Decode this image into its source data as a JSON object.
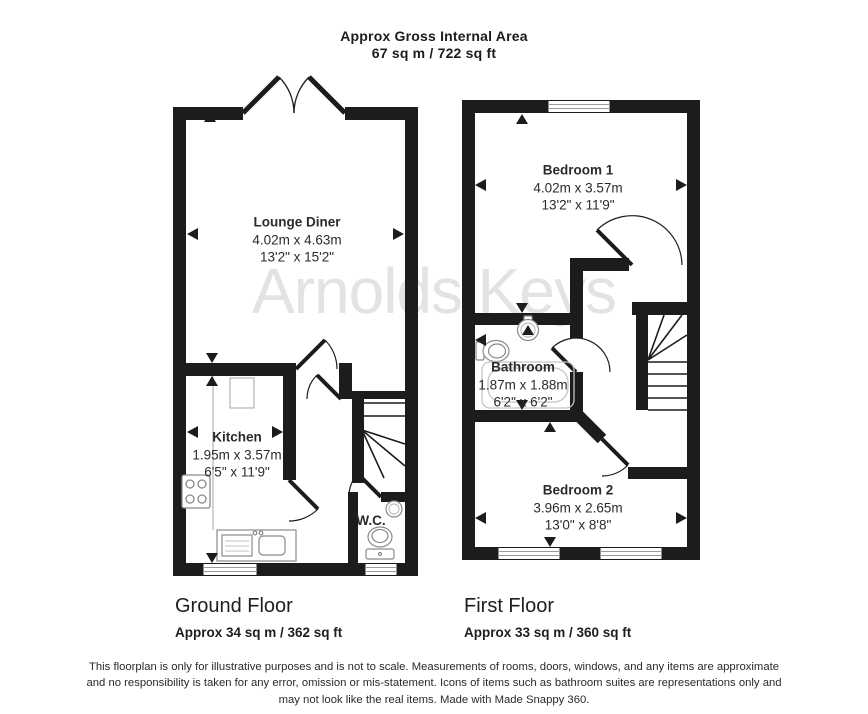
{
  "title": {
    "line1": "Approx Gross Internal Area",
    "line2": "67 sq m / 722 sq ft"
  },
  "watermark": "Arnolds|Keys",
  "ground_floor": {
    "caption": "Ground Floor",
    "area": "Approx 34 sq m / 362 sq ft",
    "rooms": {
      "lounge": {
        "name": "Lounge Diner",
        "metric": "4.02m x 4.63m",
        "imperial": "13'2\" x 15'2\""
      },
      "kitchen": {
        "name": "Kitchen",
        "metric": "1.95m x 3.57m",
        "imperial": "6'5\" x 11'9\""
      },
      "wc": {
        "name": "W.C."
      }
    }
  },
  "first_floor": {
    "caption": "First Floor",
    "area": "Approx 33 sq m / 360 sq ft",
    "rooms": {
      "bedroom1": {
        "name": "Bedroom 1",
        "metric": "4.02m x 3.57m",
        "imperial": "13'2\" x 11'9\""
      },
      "bathroom": {
        "name": "Bathroom",
        "metric": "1.87m x 1.88m",
        "imperial": "6'2\" x 6'2\""
      },
      "bedroom2": {
        "name": "Bedroom 2",
        "metric": "3.96m x 2.65m",
        "imperial": "13'0\" x 8'8\""
      }
    }
  },
  "disclaimer": {
    "lines": [
      "This floorplan is only for illustrative purposes and is not to scale. Measurements of rooms, doors, windows, and any items are approximate",
      "and no responsibility is taken for any error, omission or mis-statement. Icons of items such as bathroom suites are representations only and",
      "may not look like the real items. Made with Made Snappy 360."
    ]
  }
}
